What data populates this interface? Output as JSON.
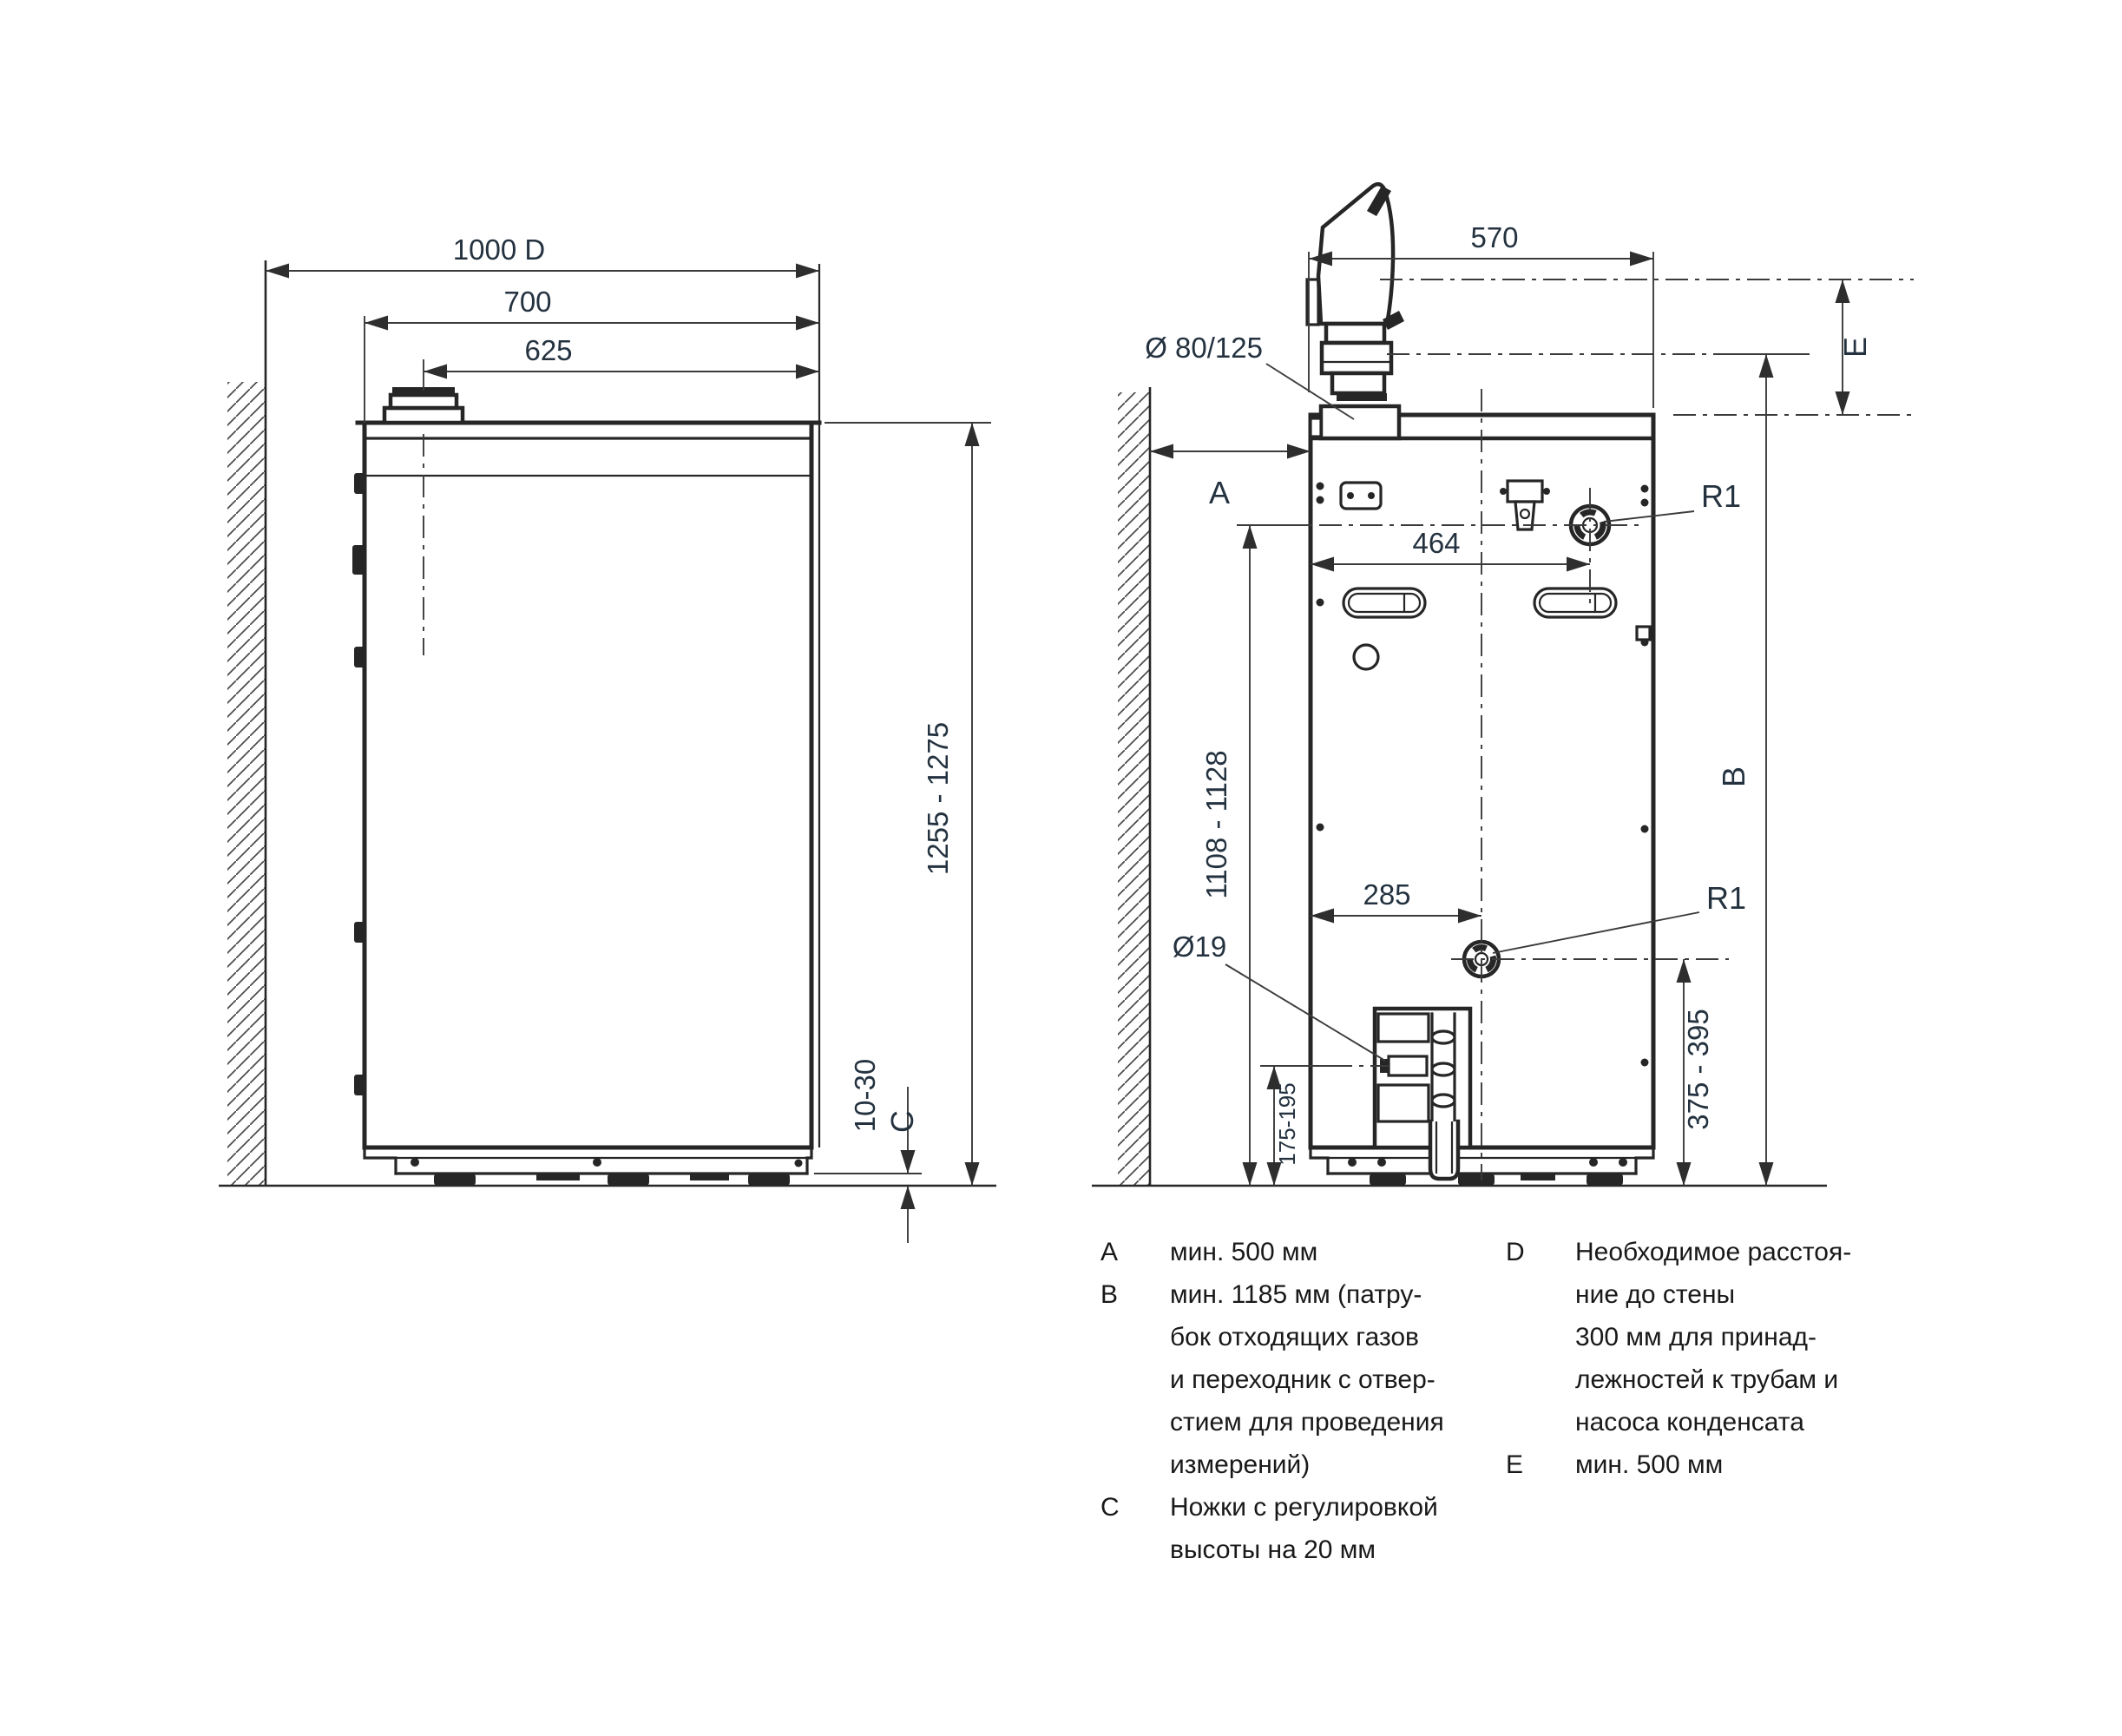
{
  "drawing": {
    "type": "installation-dimensions-technical-drawing",
    "views": [
      "side-view-left",
      "rear-view-right"
    ]
  },
  "labels": {
    "left": {
      "total_from_wall": "1000 D",
      "depth": "700",
      "flue_to_front": "625",
      "height_range": "1255 - 1275",
      "feet_adjust": "10-30",
      "feet_key": "C"
    },
    "right": {
      "width": "570",
      "flue_diameter": "Ø 80/125",
      "clearance_key": "A",
      "flow_offset": "464",
      "r1_top": "R1",
      "return_offset": "285",
      "r1_bottom": "R1",
      "condensate_diameter": "Ø19",
      "flue_center_height": "1108 - 1128",
      "return_height": "375 - 395",
      "condensate_height": "175-195",
      "height_key": "B",
      "top_clearance_key": "E"
    }
  },
  "legend": {
    "items": [
      {
        "key": "A",
        "lines": [
          "мин. 500 мм"
        ]
      },
      {
        "key": "B",
        "lines": [
          "мин. 1185 мм (патру-",
          "бок отходящих газов",
          "и переходник с отвер-",
          "стием для проведения",
          "измерений)"
        ]
      },
      {
        "key": "C",
        "lines": [
          "Ножки с регулировкой",
          "высоты на 20 мм"
        ]
      },
      {
        "key": "D",
        "lines": [
          "Необходимое расстоя-",
          "ние до стены",
          "300 мм для принад-",
          "лежностей к трубам и",
          "насоса конденсата"
        ]
      },
      {
        "key": "E",
        "lines": [
          "мин. 500 мм"
        ]
      }
    ]
  }
}
